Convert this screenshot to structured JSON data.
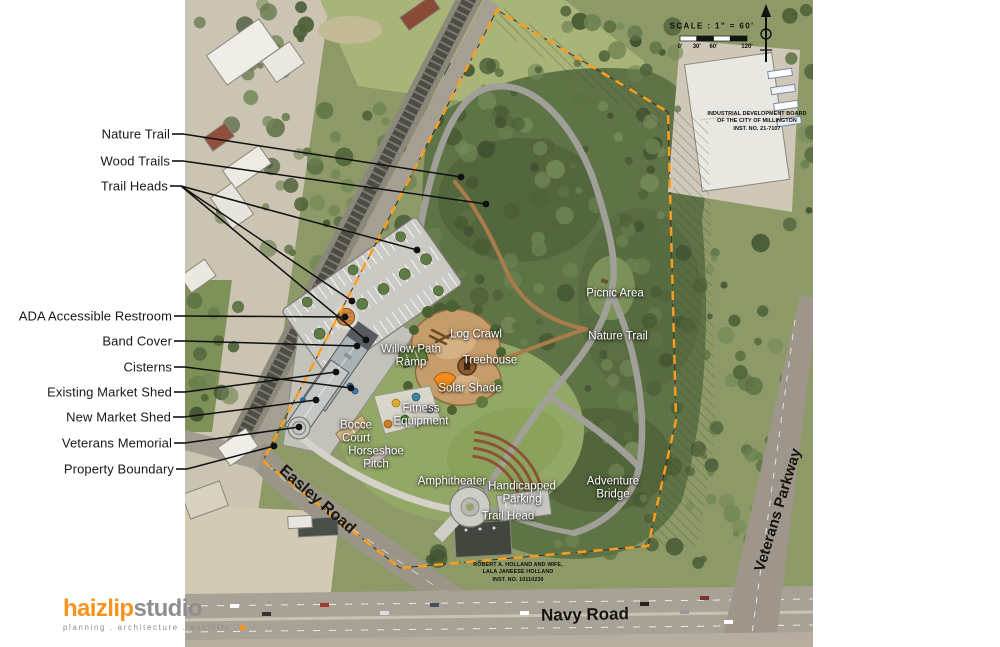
{
  "canvas": {
    "width": 1000,
    "height": 647
  },
  "colors": {
    "boundary_orange": "#FF9E1B",
    "leader_black": "#101010",
    "nature_trail_gray": "#a0a099",
    "wood_trail_brown": "#aa7c4c",
    "logo_orange": "#F7941E",
    "logo_gray": "#8E8E90"
  },
  "logo": {
    "primary": "haizlip",
    "secondary": "studio",
    "tagline": "planning . architecture . exhibits ."
  },
  "scale_block": {
    "title": "SCALE : 1\" = 60'",
    "ticks": [
      "0'",
      "30'",
      "60'",
      "120'"
    ]
  },
  "callouts": [
    {
      "id": "nature-trail",
      "label": "Nature Trail",
      "x": 170,
      "y": 134,
      "targets": [
        [
          461,
          177
        ]
      ]
    },
    {
      "id": "wood-trails",
      "label": "Wood Trails",
      "x": 170,
      "y": 161,
      "targets": [
        [
          486,
          204
        ]
      ]
    },
    {
      "id": "trail-heads",
      "label": "Trail Heads",
      "x": 168,
      "y": 186,
      "targets": [
        [
          417,
          250
        ],
        [
          352,
          301
        ],
        [
          366,
          340
        ]
      ]
    },
    {
      "id": "ada-accessible-restroom",
      "label": "ADA Accessible Restroom",
      "x": 172,
      "y": 316,
      "targets": [
        [
          345,
          317
        ]
      ]
    },
    {
      "id": "band-cover",
      "label": "Band Cover",
      "x": 172,
      "y": 341,
      "targets": [
        [
          357,
          346
        ]
      ]
    },
    {
      "id": "cisterns",
      "label": "Cisterns",
      "x": 172,
      "y": 367,
      "targets": [
        [
          351,
          388
        ]
      ]
    },
    {
      "id": "existing-market-shed",
      "label": "Existing Market Shed",
      "x": 172,
      "y": 392,
      "targets": [
        [
          336,
          372
        ]
      ]
    },
    {
      "id": "new-market-shed",
      "label": "New Market Shed",
      "x": 171,
      "y": 417,
      "targets": [
        [
          316,
          400
        ]
      ]
    },
    {
      "id": "veterans-memorial",
      "label": "Veterans Memorial",
      "x": 172,
      "y": 443,
      "targets": [
        [
          299,
          427
        ]
      ]
    },
    {
      "id": "property-boundary",
      "label": "Property Boundary",
      "x": 174,
      "y": 469,
      "targets": [
        [
          274,
          446
        ]
      ]
    }
  ],
  "map_labels": [
    {
      "id": "picnic-area",
      "lines": [
        "Picnic Area"
      ],
      "x": 615,
      "y": 294
    },
    {
      "id": "nature-trail-map",
      "lines": [
        "Nature Trail"
      ],
      "x": 618,
      "y": 337
    },
    {
      "id": "log-crawl",
      "lines": [
        "Log Crawl"
      ],
      "x": 476,
      "y": 335
    },
    {
      "id": "willow-path-ramp",
      "lines": [
        "Willow Path",
        "Ramp"
      ],
      "x": 411,
      "y": 356
    },
    {
      "id": "treehouse",
      "lines": [
        "Treehouse"
      ],
      "x": 490,
      "y": 361
    },
    {
      "id": "solar-shade",
      "lines": [
        "Solar Shade"
      ],
      "x": 470,
      "y": 389
    },
    {
      "id": "fitness-equipment",
      "lines": [
        "Fitness",
        "Equipment"
      ],
      "x": 421,
      "y": 415
    },
    {
      "id": "bocce-court",
      "lines": [
        "Bocce",
        "Court"
      ],
      "x": 356,
      "y": 432
    },
    {
      "id": "horseshoe-pitch",
      "lines": [
        "Horseshoe",
        "Pitch"
      ],
      "x": 376,
      "y": 458
    },
    {
      "id": "amphitheater",
      "lines": [
        "Amphitheater"
      ],
      "x": 452,
      "y": 482
    },
    {
      "id": "handicapped-parking",
      "lines": [
        "Handicapped",
        "Parking"
      ],
      "x": 522,
      "y": 493
    },
    {
      "id": "trail-head",
      "lines": [
        "Trail Head"
      ],
      "x": 508,
      "y": 517
    },
    {
      "id": "adventure-bridge",
      "lines": [
        "Adventure",
        "Bridge"
      ],
      "x": 613,
      "y": 488
    }
  ],
  "road_labels": [
    {
      "id": "easley-road",
      "text": "Easley Road",
      "x": 317,
      "y": 500,
      "rotate": 41,
      "size": 16
    },
    {
      "id": "navy-road",
      "text": "Navy Road",
      "x": 585,
      "y": 615,
      "rotate": -1,
      "size": 17
    },
    {
      "id": "veterans-parkway",
      "text": "Veterans Parkway",
      "x": 778,
      "y": 510,
      "rotate": -73,
      "size": 15
    }
  ],
  "parcel_notes": [
    {
      "id": "industrial-development-board",
      "lines": [
        "INDUSTRIAL DEVELOPMENT BOARD",
        "OF THE CITY OF MILLINGTON",
        "INST. NO. 21-7107"
      ],
      "x": 757,
      "y": 122
    },
    {
      "id": "holland-parcel",
      "lines": [
        "ROBERT A. HOLLAND AND WIFE,",
        "LALA JANEESE HOLLAND",
        "INST. NO. 10110230"
      ],
      "x": 518,
      "y": 573
    }
  ]
}
